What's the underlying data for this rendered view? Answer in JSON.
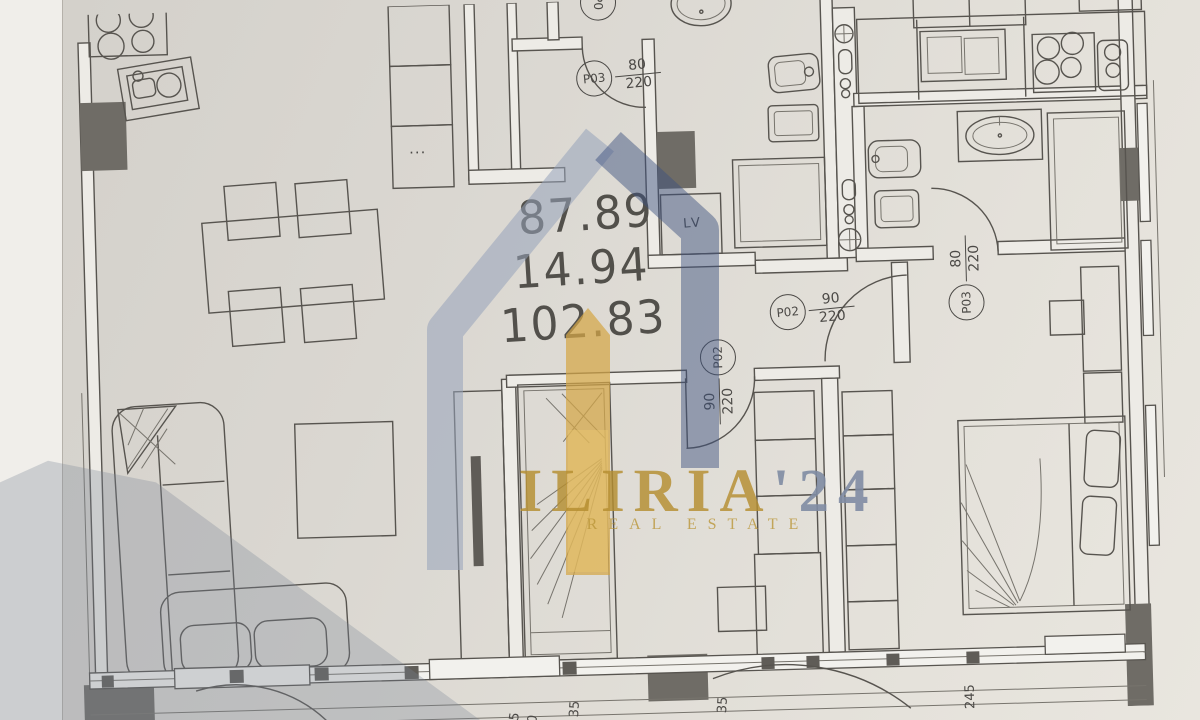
{
  "colors": {
    "paper": "#dedbd5",
    "ink": "#57544f",
    "column_fill": "#6f6c66",
    "watermark_slate": "#96a2ba",
    "watermark_navy": "#3d5280",
    "watermark_gold": "#d4a646",
    "brand_gold": "#b48e30",
    "brand_slate": "#808ca3"
  },
  "areas": {
    "net": "87.89",
    "balcony": "14.94",
    "total": "102.83"
  },
  "doors": {
    "bath_main": {
      "id": "P03",
      "width": "80",
      "height": "220"
    },
    "kids_room": {
      "id": "P02",
      "width": "90",
      "height": "220"
    },
    "corridor": {
      "id": "P02",
      "width": "90",
      "height": "220"
    },
    "master": {
      "id": "P03",
      "width": "80",
      "height": "220"
    },
    "top_partial": {
      "id": "P0"
    }
  },
  "labels": {
    "washing_machine": "LV",
    "cabinet_dots": "···"
  },
  "dimensions": {
    "balcony_depth": "245",
    "dim_35_left": "35",
    "dim_35_right": "35",
    "dim_5": "5",
    "dim_0": "0"
  },
  "watermark": {
    "brand": "ILIRIA",
    "year": "'24",
    "tagline": "REAL ESTATE"
  }
}
